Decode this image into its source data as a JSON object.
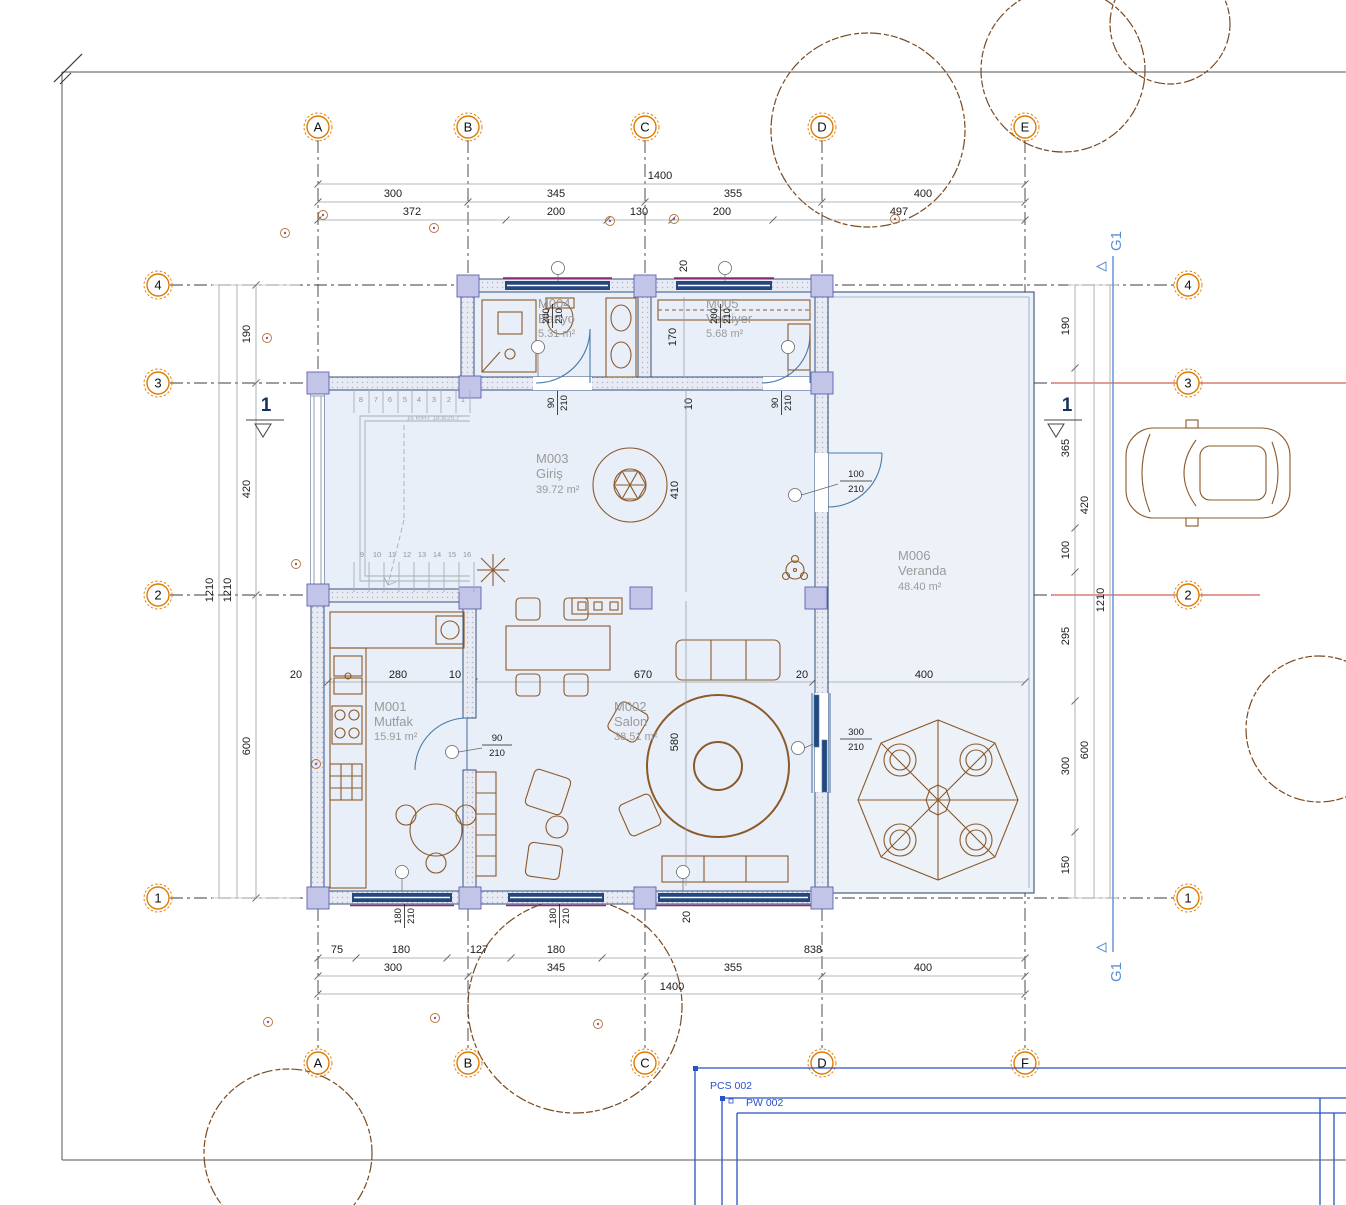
{
  "drawing": {
    "grid": {
      "columns_top": [
        "A",
        "B",
        "C",
        "D",
        "E"
      ],
      "columns_bottom": [
        "A",
        "B",
        "C",
        "D",
        "F"
      ],
      "rows": [
        "4",
        "3",
        "2",
        "1"
      ]
    },
    "dimensions": {
      "top": {
        "total": "1400",
        "major": [
          "300",
          "345",
          "355",
          "400"
        ],
        "minor": [
          "372",
          "200",
          "130",
          "200",
          "497"
        ],
        "gap": "20"
      },
      "bottom": {
        "total": "1400",
        "major": [
          "300",
          "345",
          "355",
          "400"
        ],
        "minor": [
          "75",
          "180",
          "127",
          "180",
          "838"
        ],
        "gap": "20"
      },
      "left": {
        "segments": [
          "190",
          "420",
          "600"
        ],
        "total_a": "1210",
        "total_b": "1210"
      },
      "right": {
        "segments": [
          "190",
          "365",
          "100",
          "295",
          "300",
          "150"
        ],
        "outer": [
          "420",
          "600"
        ],
        "total": "1210"
      },
      "middle": [
        "20",
        "280",
        "10",
        "670",
        "20",
        "400"
      ],
      "interior": {
        "vestiyer_depth": "170",
        "wall_gap": "10",
        "giris_depth": "410",
        "salon_depth": "580"
      }
    },
    "rooms": [
      {
        "id": "M001",
        "name": "Mutfak",
        "area": "15.91 m²"
      },
      {
        "id": "M002",
        "name": "Salon",
        "area": "38.51 m²"
      },
      {
        "id": "M003",
        "name": "Giriş",
        "area": "39.72 m²"
      },
      {
        "id": "M004",
        "name": "Banyo",
        "area": "5.31 m²"
      },
      {
        "id": "M005",
        "name": "Vestiyer",
        "area": "5.68 m²"
      },
      {
        "id": "M006",
        "name": "Veranda",
        "area": "48.40 m²"
      }
    ],
    "openings": {
      "window_north_1": {
        "w": "200",
        "h": "210"
      },
      "window_north_2": {
        "w": "200",
        "h": "210"
      },
      "door_banyo": {
        "w": "90",
        "h": "210"
      },
      "door_vestiyer": {
        "w": "90",
        "h": "210"
      },
      "door_giris_east": {
        "w": "100",
        "h": "210"
      },
      "door_mutfak": {
        "w": "90",
        "h": "210"
      },
      "door_salon_east": {
        "w": "300",
        "h": "210"
      },
      "window_south_1": {
        "w": "180",
        "h": "210"
      },
      "window_south_2": {
        "w": "180",
        "h": "210"
      }
    },
    "stairs": {
      "upper": [
        "8",
        "7",
        "6",
        "5",
        "4",
        "3",
        "2",
        "1"
      ],
      "lower": [
        "9",
        "10",
        "11",
        "12",
        "13",
        "14",
        "15",
        "16"
      ],
      "note": "16 RIHT 18.8/25.7"
    },
    "section_marker": "1",
    "reference_grid_label": "G1",
    "annotations": {
      "pcs": "PCS 002",
      "pw": "PW 002"
    },
    "colors": {
      "grid_bubble": "#e07b00",
      "red_line": "#c0392b",
      "reference_blue": "#5b8fd4",
      "frame_blue": "#2b50c8",
      "wall_navy": "#24477e",
      "column_lavender": "#c3c5e8",
      "floor_fill": "#e9eff8",
      "furniture_brown": "#8a5a2b",
      "magenta_frame": "#a0206a",
      "room_label_gray": "#9a9a9a"
    }
  }
}
